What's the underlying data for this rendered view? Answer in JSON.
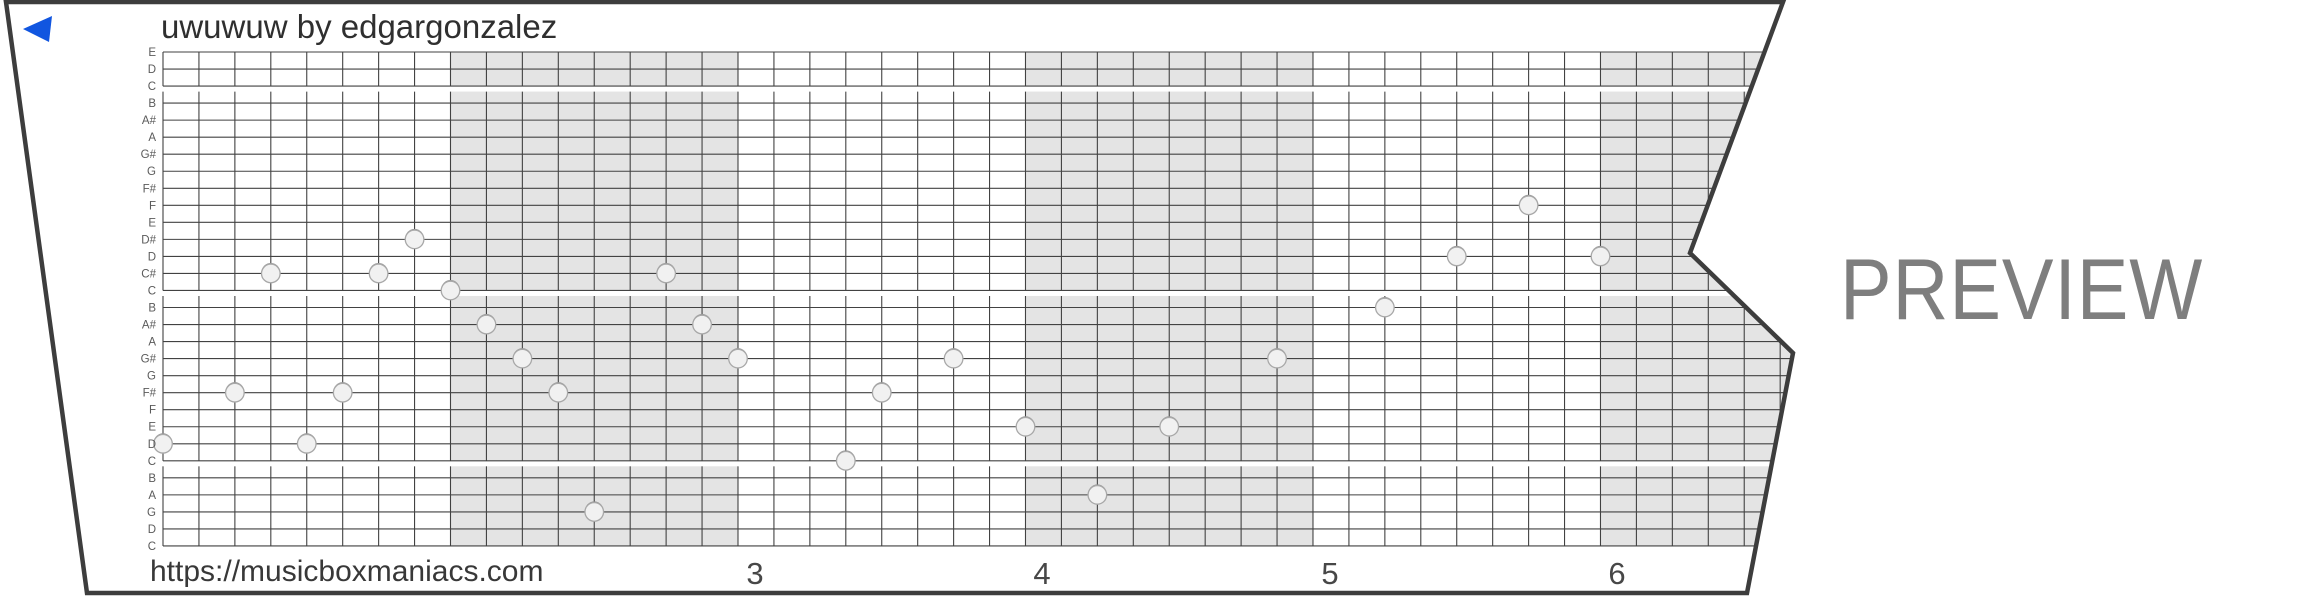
{
  "title": "uwuwuw by edgargonzalez",
  "footer_url": "https://musicboxmaniacs.com",
  "watermark": "PREVIEW",
  "player": {
    "play_icon": "play-left-triangle"
  },
  "colors": {
    "accent_blue": "#1156e0",
    "paper": "#ffffff",
    "border": "#3d3d3d",
    "grid_line": "#424242",
    "band_gray": "#e4e4e4",
    "note_fill": "#f1f1f1",
    "note_rim": "#959595",
    "note_stroke": "#a8a8a8",
    "row_label": "#5a5a5a",
    "measure_number": "#474747",
    "text_dark": "#2f2f2f",
    "watermark_gray": "#7e7e7e"
  },
  "row_labels": [
    "E",
    "D",
    "C",
    "B",
    "A#",
    "A",
    "G#",
    "G",
    "F#",
    "F",
    "E",
    "D#",
    "D",
    "C#",
    "C",
    "B",
    "A#",
    "A",
    "G#",
    "G",
    "F#",
    "F",
    "E",
    "D",
    "C",
    "B",
    "A",
    "G",
    "D",
    "C"
  ],
  "measure_numbers": [
    {
      "label": "3",
      "x": 755
    },
    {
      "label": "4",
      "x": 1042
    },
    {
      "label": "5",
      "x": 1330
    },
    {
      "label": "6",
      "x": 1617
    }
  ],
  "geometry": {
    "outline": [
      [
        6,
        2
      ],
      [
        1783,
        2
      ],
      [
        1690,
        253
      ],
      [
        1793,
        353
      ],
      [
        1747,
        593
      ],
      [
        87,
        593
      ]
    ],
    "grid_left": 163,
    "grid_top": 52,
    "cell_w": 35.937,
    "cell_h": 17.034,
    "rows": 30,
    "steps_per_measure": 8,
    "gray_measures": [
      1,
      3,
      5
    ],
    "octave_break_rows": [
      2,
      14,
      24
    ],
    "octave_gap_px": 5.5,
    "grid_right_max": 1810,
    "label_x": 156,
    "measure_number_y": 584,
    "note_radius": 9.3,
    "play_triangle": [
      [
        23,
        29
      ],
      [
        52,
        16
      ],
      [
        49,
        42
      ]
    ]
  },
  "chart_data": {
    "type": "piano-roll",
    "description": "30-note music box strip, eighth-note grid, measures 1-6 visible, alternating measures shaded",
    "steps_per_measure": 8,
    "visible_measure_labels": [
      "3",
      "4",
      "5",
      "6"
    ],
    "row_axis_top_to_bottom": [
      "E",
      "D",
      "C",
      "B",
      "A#",
      "A",
      "G#",
      "G",
      "F#",
      "F",
      "E",
      "D#",
      "D",
      "C#",
      "C",
      "B",
      "A#",
      "A",
      "G#",
      "G",
      "F#",
      "F",
      "E",
      "D",
      "C",
      "B",
      "A",
      "G",
      "D",
      "C"
    ],
    "notes": [
      {
        "step": 0,
        "row": 23,
        "pitch": "D"
      },
      {
        "step": 2,
        "row": 20,
        "pitch": "F#"
      },
      {
        "step": 3,
        "row": 13,
        "pitch": "C#"
      },
      {
        "step": 4,
        "row": 23,
        "pitch": "D"
      },
      {
        "step": 5,
        "row": 20,
        "pitch": "F#"
      },
      {
        "step": 6,
        "row": 13,
        "pitch": "C#"
      },
      {
        "step": 7,
        "row": 11,
        "pitch": "D#"
      },
      {
        "step": 8,
        "row": 14,
        "pitch": "C"
      },
      {
        "step": 9,
        "row": 16,
        "pitch": "A#"
      },
      {
        "step": 10,
        "row": 18,
        "pitch": "G#"
      },
      {
        "step": 11,
        "row": 20,
        "pitch": "F#"
      },
      {
        "step": 12,
        "row": 27,
        "pitch": "G"
      },
      {
        "step": 14,
        "row": 13,
        "pitch": "C#"
      },
      {
        "step": 15,
        "row": 16,
        "pitch": "A#"
      },
      {
        "step": 16,
        "row": 18,
        "pitch": "G#"
      },
      {
        "step": 19,
        "row": 24,
        "pitch": "C"
      },
      {
        "step": 20,
        "row": 20,
        "pitch": "F#"
      },
      {
        "step": 22,
        "row": 18,
        "pitch": "G#"
      },
      {
        "step": 24,
        "row": 22,
        "pitch": "E"
      },
      {
        "step": 26,
        "row": 26,
        "pitch": "A"
      },
      {
        "step": 28,
        "row": 22,
        "pitch": "E"
      },
      {
        "step": 31,
        "row": 18,
        "pitch": "G#"
      },
      {
        "step": 34,
        "row": 15,
        "pitch": "B"
      },
      {
        "step": 36,
        "row": 12,
        "pitch": "D"
      },
      {
        "step": 38,
        "row": 9,
        "pitch": "F"
      },
      {
        "step": 40,
        "row": 12,
        "pitch": "D"
      }
    ]
  }
}
